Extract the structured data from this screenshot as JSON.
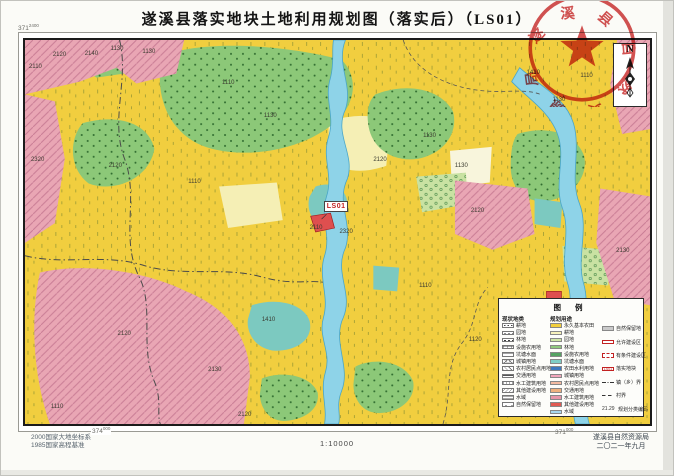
{
  "title": "遂溪县落实地块土地利用规划图（落实后）（LS01）",
  "stamp": {
    "text": "遂溪县自然资源局",
    "color": "#cc3333"
  },
  "north_label": "N",
  "map": {
    "ls01_label": "LS01",
    "grid_labels": [
      {
        "big": "371",
        "small": "2400",
        "pos": "tl"
      },
      {
        "big": "374",
        "small": "000",
        "pos": "bl"
      },
      {
        "big": "371",
        "small": "000",
        "pos": "bb"
      }
    ],
    "parcel_labels": [
      {
        "t": "2110",
        "x": 6,
        "y": 24
      },
      {
        "t": "2120",
        "x": 30,
        "y": 12
      },
      {
        "t": "2140",
        "x": 62,
        "y": 11
      },
      {
        "t": "1130",
        "x": 88,
        "y": 6
      },
      {
        "t": "1130",
        "x": 120,
        "y": 9
      },
      {
        "t": "1110",
        "x": 200,
        "y": 40
      },
      {
        "t": "1130",
        "x": 242,
        "y": 74
      },
      {
        "t": "2320",
        "x": 8,
        "y": 118
      },
      {
        "t": "2120",
        "x": 86,
        "y": 124
      },
      {
        "t": "1110",
        "x": 166,
        "y": 140
      },
      {
        "t": "2120",
        "x": 352,
        "y": 118
      },
      {
        "t": "1130",
        "x": 402,
        "y": 94
      },
      {
        "t": "1410",
        "x": 506,
        "y": 30
      },
      {
        "t": "1110",
        "x": 560,
        "y": 33
      },
      {
        "t": "1130",
        "x": 532,
        "y": 58
      },
      {
        "t": "1130",
        "x": 434,
        "y": 124
      },
      {
        "t": "2120",
        "x": 450,
        "y": 170
      },
      {
        "t": "1110",
        "x": 398,
        "y": 246
      },
      {
        "t": "2110",
        "x": 288,
        "y": 187
      },
      {
        "t": "2320",
        "x": 318,
        "y": 191
      },
      {
        "t": "1410",
        "x": 240,
        "y": 280
      },
      {
        "t": "2120",
        "x": 95,
        "y": 294
      },
      {
        "t": "2130",
        "x": 186,
        "y": 330
      },
      {
        "t": "2330",
        "x": 508,
        "y": 262
      },
      {
        "t": "2130",
        "x": 596,
        "y": 210
      },
      {
        "t": "1120",
        "x": 448,
        "y": 300
      },
      {
        "t": "1110",
        "x": 28,
        "y": 368
      },
      {
        "t": "2120",
        "x": 216,
        "y": 376
      }
    ]
  },
  "legend": {
    "title": "图  例",
    "columns": [
      {
        "header": "现状地类",
        "items": [
          {
            "label": "耕地",
            "swatch": "pat-dots"
          },
          {
            "label": "园地",
            "swatch": "pat-circles"
          },
          {
            "label": "林地",
            "swatch": "pat-forest"
          },
          {
            "label": "设施农用地",
            "swatch": "pat-grid"
          },
          {
            "label": "坑塘水面",
            "swatch": "pat-waves"
          },
          {
            "label": "城镇用地",
            "swatch": "pat-cross"
          },
          {
            "label": "农村居民点用地",
            "swatch": "pat-diag"
          },
          {
            "label": "交通用地",
            "swatch": "pat-hlines2"
          },
          {
            "label": "水工建筑用地",
            "swatch": "pat-vlines"
          },
          {
            "label": "其他建设用地",
            "swatch": "pat-diag2"
          },
          {
            "label": "水域",
            "swatch": "pat-hlines"
          },
          {
            "label": "自然保留地",
            "swatch": "pat-sparse"
          }
        ]
      },
      {
        "header": "规划用途",
        "items": [
          {
            "label": "永久基本农田",
            "swatch": "color",
            "color": "#F2CF3D"
          },
          {
            "label": "耕地",
            "swatch": "color",
            "color": "#F7F2BC"
          },
          {
            "label": "园地",
            "swatch": "color",
            "color": "#CFE6A8"
          },
          {
            "label": "林地",
            "swatch": "color",
            "color": "#8FC97E"
          },
          {
            "label": "设施农用地",
            "swatch": "color",
            "color": "#55A262"
          },
          {
            "label": "坑塘水面",
            "swatch": "color",
            "color": "#7FCDC5"
          },
          {
            "label": "农田水利用地",
            "swatch": "color",
            "color": "#3E78BE"
          },
          {
            "label": "城镇用地",
            "swatch": "color",
            "color": "#F2A7BC"
          },
          {
            "label": "农村居民点用地",
            "swatch": "color",
            "color": "#F3BBA2"
          },
          {
            "label": "交通用地",
            "swatch": "color",
            "color": "#EFB07E"
          },
          {
            "label": "水工建筑用地",
            "swatch": "color",
            "color": "#E795A9"
          },
          {
            "label": "其他建设用地",
            "swatch": "color",
            "color": "#E05A52"
          },
          {
            "label": "水域",
            "swatch": "color",
            "color": "#A9D7EF"
          }
        ]
      },
      {
        "header": "",
        "items": [
          {
            "label": "自然保留地",
            "swatch": "color",
            "color": "#CACACA"
          },
          {
            "label": "允许建设区",
            "swatch": "outline"
          },
          {
            "label": "有条件建设区",
            "swatch": "outline-dash"
          },
          {
            "label": "落实地块",
            "swatch": "lsbox",
            "text": "LS01"
          },
          {
            "label": "镇（乡）界",
            "swatch": "line-dashdot"
          },
          {
            "label": "村界",
            "swatch": "line-dash"
          },
          {
            "label": "规划分类编码",
            "swatch": "code",
            "text": "21.29"
          }
        ]
      }
    ]
  },
  "footer": {
    "datum_line1": "2000国家大地坐标系",
    "datum_line2": "1985国家高程基准",
    "scale": "1:10000",
    "agency_line1": "遂溪县自然资源局",
    "agency_line2": "二〇二一年九月"
  }
}
